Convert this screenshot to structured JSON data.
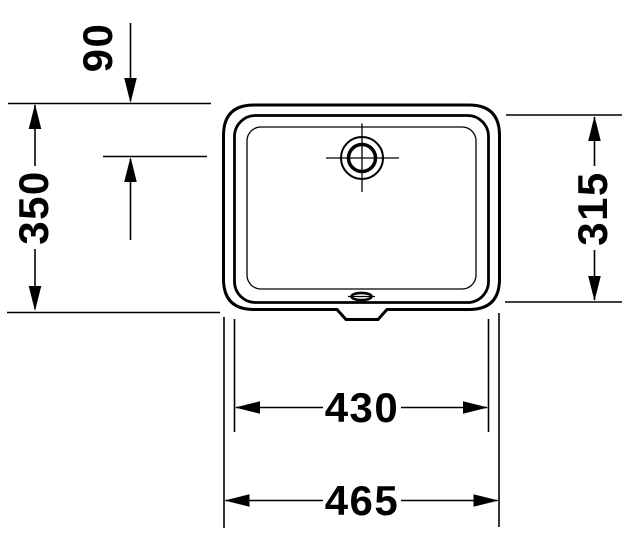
{
  "drawing": {
    "kind": "basin-technical-drawing-top-view",
    "dimensions": {
      "overflow_offset": "90",
      "outer_depth": "350",
      "bowl_depth": "315",
      "bowl_width": "430",
      "outer_width": "465"
    }
  },
  "colors": {
    "line": "#000000",
    "background": "#ffffff"
  }
}
